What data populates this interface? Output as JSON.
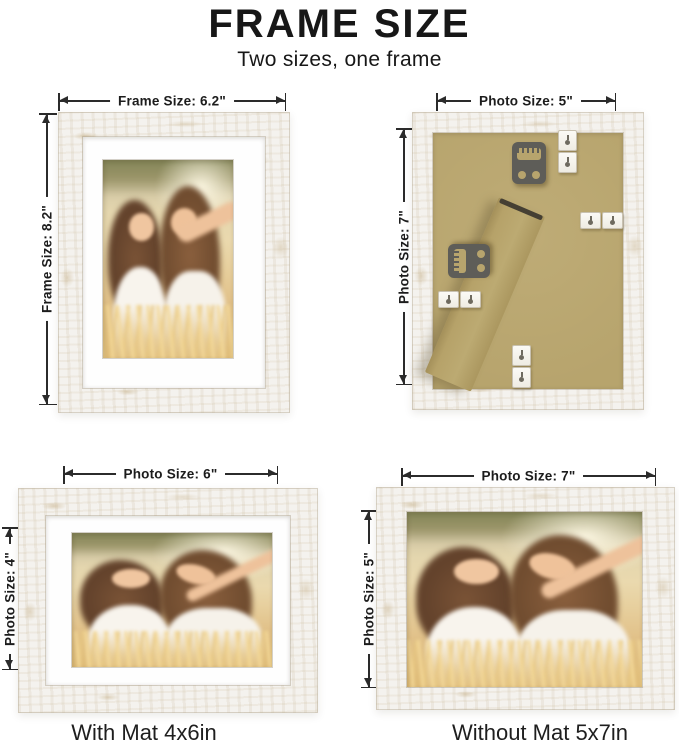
{
  "page": {
    "title": "FRAME SIZE",
    "subtitle": "Two sizes, one frame"
  },
  "colors": {
    "background": "#ffffff",
    "text": "#1c1c1c",
    "dimension_line": "#2b2b2b",
    "frame_wood": "#f4f2ee",
    "frame_distress": "#c6b088",
    "mat": "#fefefe",
    "kraft_backing": "#b7a46d",
    "hardware_dark_gray": "#5e5d58",
    "hardware_white_metal": "#f7f5ef"
  },
  "frames": {
    "front_portrait": {
      "top_label": "Frame Size: 6.2\"",
      "left_label": "Frame Size: 8.2\""
    },
    "back_view": {
      "top_label": "Photo Size: 5\"",
      "left_label": "Photo Size: 7\""
    },
    "with_mat": {
      "top_label": "Photo Size: 6\"",
      "left_label": "Photo Size: 4\"",
      "caption": "With Mat 4x6in"
    },
    "without_mat": {
      "top_label": "Photo Size: 7\"",
      "left_label": "Photo Size: 5\"",
      "caption": "Without Mat 5x7in"
    }
  }
}
